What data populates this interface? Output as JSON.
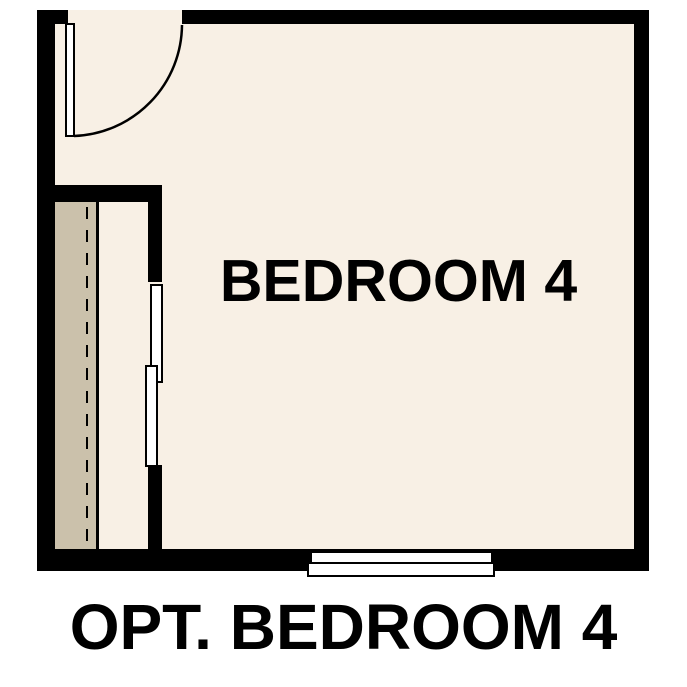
{
  "floorplan": {
    "room_label": "BEDROOM 4",
    "caption": "OPT. BEDROOM 4",
    "colors": {
      "wall": "#000000",
      "floor": "#f8f0e5",
      "closet_floor": "#cbc1ab",
      "fixture_fill": "#ffffff",
      "text": "#000000",
      "background": "#ffffff"
    }
  }
}
